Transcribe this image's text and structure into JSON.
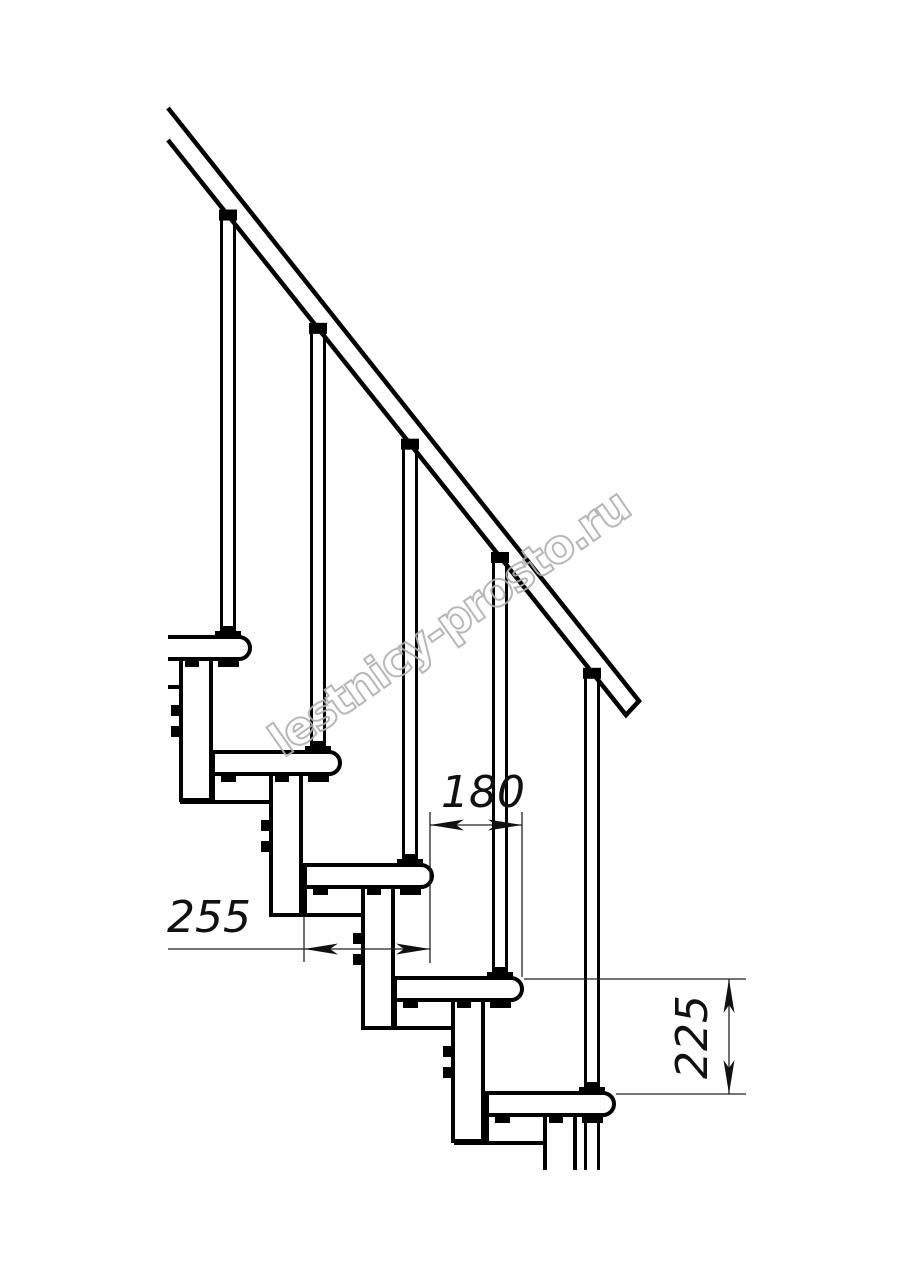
{
  "drawing": {
    "name": "modular-staircase-side-view",
    "canvas": {
      "w": 914,
      "h": 1280
    },
    "colors": {
      "line": "#000000",
      "fill": "#ffffff",
      "dim": "#222222",
      "arrow": "#111111",
      "watermark": "#b0b0b0"
    },
    "watermark": {
      "text": "lestnicy-prosto.ru",
      "cx": 458,
      "cy": 636,
      "angle": -35
    },
    "handrail": {
      "path": "M168,108 L639,701 L626,715 L168,140"
    },
    "rail_bottom": {
      "x0": 168,
      "y0": 140,
      "slope": 1.259
    },
    "clip": {
      "left": 168,
      "bottom": 1170
    },
    "tread": {
      "w": 127,
      "h": 22,
      "r": 11
    },
    "column": {
      "dx": 58,
      "w": 30,
      "len": 141
    },
    "baluster": {
      "dx": 105,
      "half_gap": 6.5
    },
    "modules": [
      {
        "x": 123,
        "y": 637,
        "clipped_left": true,
        "last": false
      },
      {
        "x": 213,
        "y": 752,
        "clipped_left": false,
        "last": false
      },
      {
        "x": 305,
        "y": 865,
        "clipped_left": false,
        "last": false
      },
      {
        "x": 395,
        "y": 978,
        "clipped_left": false,
        "last": false
      },
      {
        "x": 487,
        "y": 1093,
        "clipped_left": false,
        "last": true
      }
    ],
    "dimensions": [
      {
        "id": "180",
        "label": "180",
        "type": "h",
        "y": 825,
        "x1": 430,
        "x2": 522,
        "ext": [
          [
            430,
            812,
            963
          ],
          [
            522,
            812,
            977
          ]
        ],
        "label_pos": [
          441,
          807
        ],
        "label_rotate": 0
      },
      {
        "id": "255",
        "label": "255",
        "type": "h",
        "y": 949,
        "x1": 304,
        "x2": 430,
        "line_from": 168,
        "ext": [
          [
            304,
            916,
            962
          ]
        ],
        "label_pos": [
          167,
          932
        ],
        "label_rotate": 0
      },
      {
        "id": "225",
        "label": "225",
        "type": "v",
        "x": 729,
        "y1": 979,
        "y2": 1094,
        "ext": [
          [
            979,
            524,
            746
          ],
          [
            1094,
            616,
            746
          ]
        ],
        "label_pos": [
          707,
          1079
        ],
        "label_rotate": -90
      }
    ]
  }
}
